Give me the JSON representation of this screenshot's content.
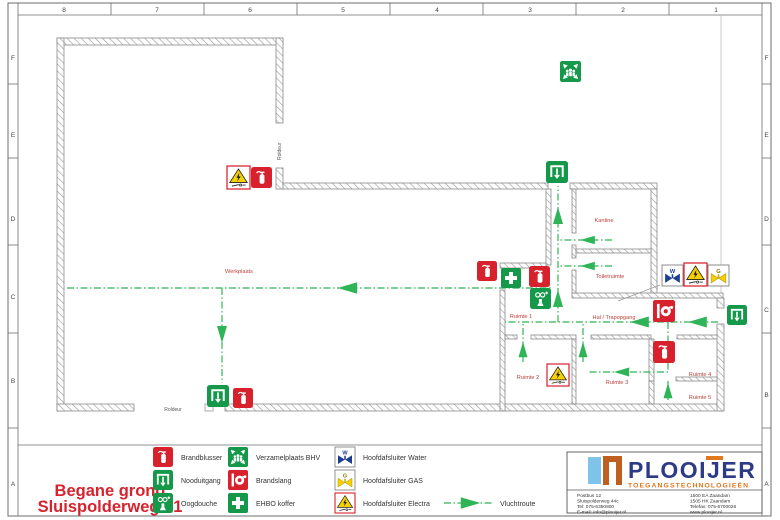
{
  "rulers": {
    "top": [
      "8",
      "7",
      "6",
      "5",
      "4",
      "3",
      "2",
      "1"
    ],
    "left": [
      "F",
      "E",
      "D",
      "C",
      "B",
      "A"
    ],
    "right": [
      "F",
      "E",
      "D",
      "C",
      "B",
      "A"
    ]
  },
  "plan": {
    "rooms": [
      {
        "label": "Werkplaats"
      },
      {
        "label": "Kantine"
      },
      {
        "label": "Toiletruimte"
      },
      {
        "label": "Ruimte 1"
      },
      {
        "label": "Hal / Trapopgang"
      },
      {
        "label": "Ruimte 2"
      },
      {
        "label": "Ruimte 3"
      },
      {
        "label": "Ruimte 4"
      },
      {
        "label": "Ruimte 5"
      }
    ],
    "doors": [
      {
        "label": "Roldeur"
      },
      {
        "label": "Roldeur"
      }
    ],
    "icons": [
      {
        "type": "assembly-point",
        "x": 560,
        "y": 61
      },
      {
        "type": "electric-shutoff",
        "x": 227,
        "y": 166
      },
      {
        "type": "fire-extinguisher",
        "x": 251,
        "y": 167
      },
      {
        "type": "emergency-exit",
        "x": 546,
        "y": 161
      },
      {
        "type": "fire-extinguisher",
        "x": 477,
        "y": 261
      },
      {
        "type": "first-aid",
        "x": 501,
        "y": 268
      },
      {
        "type": "fire-extinguisher",
        "x": 529,
        "y": 266
      },
      {
        "type": "eye-wash",
        "x": 530,
        "y": 288
      },
      {
        "type": "water-shutoff",
        "x": 662,
        "y": 265
      },
      {
        "type": "electric-shutoff",
        "x": 684,
        "y": 263
      },
      {
        "type": "gas-shutoff",
        "x": 708,
        "y": 265
      },
      {
        "type": "fire-hose",
        "x": 653,
        "y": 300
      },
      {
        "type": "emergency-exit",
        "x": 727,
        "y": 305
      },
      {
        "type": "fire-extinguisher",
        "x": 653,
        "y": 341
      },
      {
        "type": "electric-shutoff",
        "x": 547,
        "y": 364
      },
      {
        "type": "emergency-exit",
        "x": 207,
        "y": 385
      },
      {
        "type": "fire-extinguisher",
        "x": 233,
        "y": 388
      }
    ]
  },
  "icons": {
    "water_letter": "W",
    "gas_letter": "G"
  },
  "legend": {
    "items": [
      {
        "icon": "fire-extinguisher",
        "label": "Brandblusser"
      },
      {
        "icon": "emergency-exit",
        "label": "Nooduitgang"
      },
      {
        "icon": "eye-wash",
        "label": "Oogdouche"
      },
      {
        "icon": "assembly-point",
        "label": "Verzamelplaats BHV"
      },
      {
        "icon": "fire-hose",
        "label": "Brandslang"
      },
      {
        "icon": "first-aid",
        "label": "EHBO koffer"
      },
      {
        "icon": "water-shutoff",
        "label": "Hoofdafsluiter Water"
      },
      {
        "icon": "gas-shutoff",
        "label": "Hoofdafsluiter GAS"
      },
      {
        "icon": "electric-shutoff",
        "label": "Hoofdafsluiter Electra"
      }
    ],
    "route_label": "Vluchtroute"
  },
  "title": {
    "line1": "Begane grond",
    "line2": "Sluispolderweg 71"
  },
  "logo": {
    "name": "PLOOIJER",
    "tagline": "TOEGANGSTECHNOLOGIEËN",
    "address_left": [
      "Postbus 12",
      "Sluispolderweg 44c",
      "Tel: 075-6350800",
      "E-mail: info@plooijer.nl"
    ],
    "address_right": [
      "1500 EA Zaandam",
      "1505 HK Zaandam",
      "Telefax: 075-6700026",
      "www.plooijer.nl"
    ]
  },
  "colors": {
    "safety_red": "#d7222d",
    "safety_green": "#15984a",
    "valve_blue": "#1c3e8e",
    "warning_yellow": "#f6d000",
    "route_green": "#2fb457",
    "room_label_red": "#c0403d",
    "title_red": "#d6232e",
    "logo_navy": "#2d3a85",
    "logo_orange": "#e0761e"
  }
}
